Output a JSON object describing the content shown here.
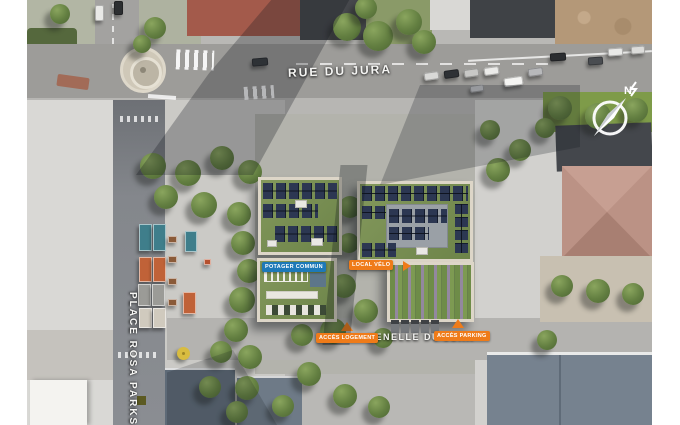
{
  "meta": {
    "title": "Site plan aerial view",
    "width": 680,
    "height": 425
  },
  "colors": {
    "accent_orange": "#ef7b19",
    "accent_blue": "#1d79b8",
    "solar_panel": "#2c3752",
    "green_roof": "#7d9257",
    "label_text": "#ffffff"
  },
  "labels": {
    "rue_du_jura": "RUE DU JURA",
    "place_rosa_parks": "PLACE ROSA PARKS",
    "venelle_du_jura": "VENELLE DU JURA",
    "potager_commun": "POTAGER COMMUN",
    "local_velo": "LOCAL VÉLO",
    "acces_logement": "ACCÈS LOGEMENT",
    "acces_parking": "ACCÈS PARKING",
    "compass_north": "N"
  },
  "features": {
    "trees": [
      {
        "x": 320,
        "y": 27,
        "r": 14
      },
      {
        "x": 351,
        "y": 36,
        "r": 15
      },
      {
        "x": 382,
        "y": 22,
        "r": 13
      },
      {
        "x": 397,
        "y": 42,
        "r": 12
      },
      {
        "x": 339,
        "y": 8,
        "r": 11
      },
      {
        "x": 128,
        "y": 28,
        "r": 11
      },
      {
        "x": 33,
        "y": 14,
        "r": 10
      },
      {
        "x": 115,
        "y": 44,
        "r": 9
      },
      {
        "x": 126,
        "y": 166,
        "r": 13
      },
      {
        "x": 161,
        "y": 173,
        "r": 13
      },
      {
        "x": 195,
        "y": 158,
        "r": 12
      },
      {
        "x": 223,
        "y": 172,
        "r": 12
      },
      {
        "x": 139,
        "y": 197,
        "r": 12
      },
      {
        "x": 177,
        "y": 205,
        "r": 13
      },
      {
        "x": 212,
        "y": 214,
        "r": 12
      },
      {
        "x": 216,
        "y": 243,
        "r": 12
      },
      {
        "x": 222,
        "y": 271,
        "r": 12
      },
      {
        "x": 215,
        "y": 300,
        "r": 13
      },
      {
        "x": 209,
        "y": 330,
        "r": 12
      },
      {
        "x": 223,
        "y": 357,
        "r": 12
      },
      {
        "x": 194,
        "y": 352,
        "r": 11
      },
      {
        "x": 220,
        "y": 388,
        "r": 12
      },
      {
        "x": 183,
        "y": 387,
        "r": 11
      },
      {
        "x": 210,
        "y": 412,
        "r": 11
      },
      {
        "x": 323,
        "y": 207,
        "r": 11
      },
      {
        "x": 322,
        "y": 243,
        "r": 10
      },
      {
        "x": 291,
        "y": 299,
        "r": 12
      },
      {
        "x": 317,
        "y": 286,
        "r": 12
      },
      {
        "x": 306,
        "y": 331,
        "r": 13
      },
      {
        "x": 275,
        "y": 335,
        "r": 11
      },
      {
        "x": 339,
        "y": 311,
        "r": 12
      },
      {
        "x": 356,
        "y": 338,
        "r": 10
      },
      {
        "x": 282,
        "y": 374,
        "r": 12
      },
      {
        "x": 318,
        "y": 396,
        "r": 12
      },
      {
        "x": 256,
        "y": 406,
        "r": 11
      },
      {
        "x": 352,
        "y": 407,
        "r": 11
      },
      {
        "x": 533,
        "y": 108,
        "r": 12
      },
      {
        "x": 571,
        "y": 116,
        "r": 13
      },
      {
        "x": 609,
        "y": 110,
        "r": 12
      },
      {
        "x": 518,
        "y": 128,
        "r": 10
      },
      {
        "x": 535,
        "y": 286,
        "r": 11
      },
      {
        "x": 571,
        "y": 291,
        "r": 12
      },
      {
        "x": 606,
        "y": 294,
        "r": 11
      },
      {
        "x": 520,
        "y": 340,
        "r": 10
      },
      {
        "x": 471,
        "y": 170,
        "r": 12
      },
      {
        "x": 493,
        "y": 150,
        "r": 11
      },
      {
        "x": 463,
        "y": 130,
        "r": 10
      }
    ],
    "cars": [
      {
        "x": 68,
        "y": 5,
        "w": 9,
        "h": 16,
        "c": "#e9e9e7",
        "rot": 0
      },
      {
        "x": 87,
        "y": 1,
        "w": 9,
        "h": 14,
        "c": "#2c2e31",
        "rot": 0
      },
      {
        "x": 225,
        "y": 58,
        "w": 16,
        "h": 8,
        "c": "#3a3d41",
        "rot": -5
      },
      {
        "x": 397,
        "y": 72,
        "w": 15,
        "h": 8,
        "c": "#d9d9d7",
        "rot": -8
      },
      {
        "x": 417,
        "y": 70,
        "w": 15,
        "h": 8,
        "c": "#2e3135",
        "rot": -8
      },
      {
        "x": 437,
        "y": 69,
        "w": 15,
        "h": 8,
        "c": "#c8c8c6",
        "rot": -8
      },
      {
        "x": 457,
        "y": 67,
        "w": 15,
        "h": 8,
        "c": "#ebebe9",
        "rot": -8
      },
      {
        "x": 477,
        "y": 77,
        "w": 19,
        "h": 9,
        "c": "#f4f4f2",
        "rot": -8
      },
      {
        "x": 501,
        "y": 68,
        "w": 15,
        "h": 8,
        "c": "#b8b9bb",
        "rot": -8
      },
      {
        "x": 443,
        "y": 85,
        "w": 14,
        "h": 7,
        "c": "#c2c3c5",
        "rot": -8
      },
      {
        "x": 523,
        "y": 53,
        "w": 16,
        "h": 8,
        "c": "#2b2d30",
        "rot": -4
      },
      {
        "x": 561,
        "y": 57,
        "w": 15,
        "h": 8,
        "c": "#4a4d51",
        "rot": -4
      },
      {
        "x": 581,
        "y": 48,
        "w": 15,
        "h": 8,
        "c": "#e9e9e7",
        "rot": -4
      },
      {
        "x": 604,
        "y": 46,
        "w": 14,
        "h": 8,
        "c": "#dcdcda",
        "rot": -4
      }
    ],
    "stalls": [
      {
        "x": 112,
        "y": 224,
        "w": 13,
        "h": 27,
        "c": "#3f7e8b"
      },
      {
        "x": 126,
        "y": 224,
        "w": 13,
        "h": 27,
        "c": "#3f7e8b"
      },
      {
        "x": 158,
        "y": 231,
        "w": 12,
        "h": 21,
        "c": "#3f7e8b"
      },
      {
        "x": 112,
        "y": 257,
        "w": 13,
        "h": 25,
        "c": "#c06238"
      },
      {
        "x": 126,
        "y": 257,
        "w": 13,
        "h": 25,
        "c": "#c06238"
      },
      {
        "x": 156,
        "y": 292,
        "w": 13,
        "h": 22,
        "c": "#c06238"
      },
      {
        "x": 111,
        "y": 284,
        "w": 13,
        "h": 22,
        "c": "#9b9b97"
      },
      {
        "x": 125,
        "y": 284,
        "w": 13,
        "h": 22,
        "c": "#9b9b97"
      },
      {
        "x": 112,
        "y": 308,
        "w": 13,
        "h": 20,
        "c": "#d0cabe"
      },
      {
        "x": 126,
        "y": 308,
        "w": 13,
        "h": 20,
        "c": "#d0cabe"
      },
      {
        "x": 141,
        "y": 236,
        "w": 9,
        "h": 7,
        "c": "#8a5a38"
      },
      {
        "x": 141,
        "y": 256,
        "w": 9,
        "h": 7,
        "c": "#8a5a38"
      },
      {
        "x": 141,
        "y": 278,
        "w": 9,
        "h": 7,
        "c": "#8a5a38"
      },
      {
        "x": 141,
        "y": 299,
        "w": 9,
        "h": 7,
        "c": "#8a5a38"
      },
      {
        "x": 177,
        "y": 259,
        "w": 7,
        "h": 6,
        "c": "#b5502e"
      }
    ],
    "shelters": [
      {
        "x": 364,
        "y": 320
      },
      {
        "x": 374,
        "y": 320
      },
      {
        "x": 384,
        "y": 320
      },
      {
        "x": 394,
        "y": 320
      },
      {
        "x": 404,
        "y": 320
      }
    ]
  }
}
